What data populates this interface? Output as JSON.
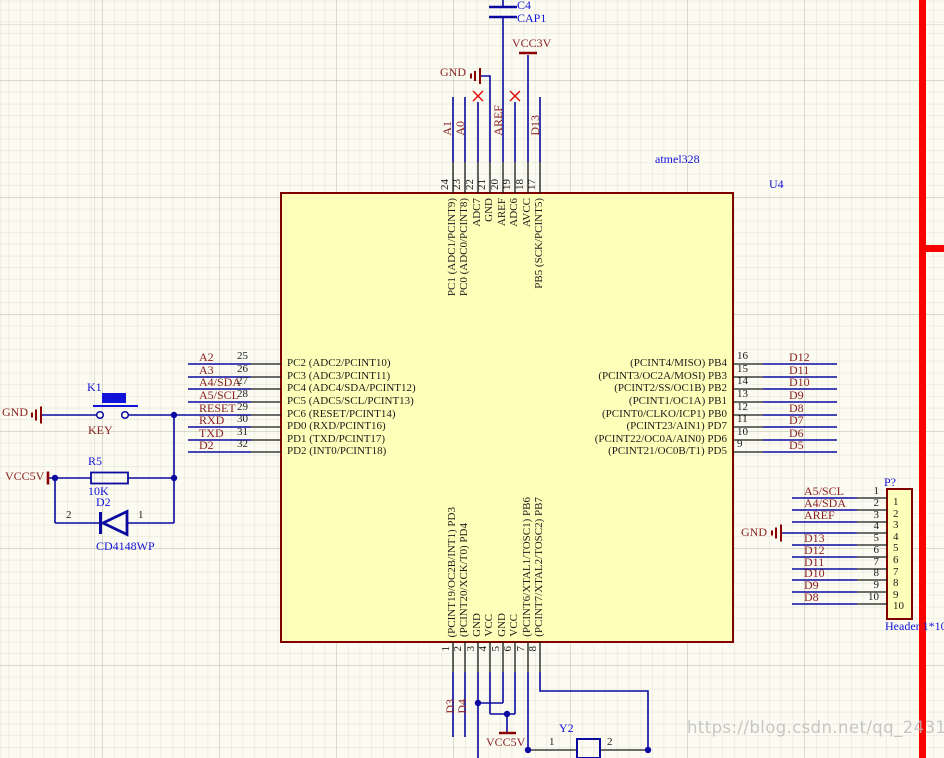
{
  "colors": {
    "wire": "#0A0AA0",
    "net_label": "#8B2222",
    "designator": "#1212D8",
    "ic_fill": "#FFFFB9",
    "ic_border": "#800000",
    "no_connect": "#E00000",
    "region_line": "#F80400"
  },
  "ic": {
    "designator": "U4",
    "comment": "atmel328",
    "top_pins": [
      {
        "num": "24",
        "net": "A1",
        "name": "PC1 (ADC1/PCINT9)"
      },
      {
        "num": "23",
        "net": "A0",
        "name": "PC0 (ADC0/PCINT8)"
      },
      {
        "num": "22",
        "net": "",
        "name": "ADC7"
      },
      {
        "num": "21",
        "net": "",
        "name": "GND"
      },
      {
        "num": "20",
        "net": "AREF",
        "name": "AREF"
      },
      {
        "num": "19",
        "net": "",
        "name": "ADC6"
      },
      {
        "num": "18",
        "net": "",
        "name": "AVCC"
      },
      {
        "num": "17",
        "net": "D13",
        "name": "PB5 (SCK/PCINT5)"
      }
    ],
    "left_pins": [
      {
        "num": "25",
        "net": "A2",
        "name": "PC2 (ADC2/PCINT10)"
      },
      {
        "num": "26",
        "net": "A3",
        "name": "PC3 (ADC3/PCINT11)"
      },
      {
        "num": "27",
        "net": "A4/SDA",
        "name": "PC4 (ADC4/SDA/PCINT12)"
      },
      {
        "num": "28",
        "net": "A5/SCL",
        "name": "PC5 (ADC5/SCL/PCINT13)"
      },
      {
        "num": "29",
        "net": "RESET",
        "name": "PC6 (RESET/PCINT14)"
      },
      {
        "num": "30",
        "net": "RXD",
        "name": "PD0 (RXD/PCINT16)"
      },
      {
        "num": "31",
        "net": "TXD",
        "name": "PD1 (TXD/PCINT17)"
      },
      {
        "num": "32",
        "net": "D2",
        "name": "PD2 (INT0/PCINT18)"
      }
    ],
    "right_pins": [
      {
        "num": "16",
        "net": "D12",
        "name": "(PCINT4/MISO) PB4"
      },
      {
        "num": "15",
        "net": "D11",
        "name": "(PCINT3/OC2A/MOSI) PB3"
      },
      {
        "num": "14",
        "net": "D10",
        "name": "(PCINT2/SS/OC1B) PB2"
      },
      {
        "num": "13",
        "net": "D9",
        "name": "(PCINT1/OC1A) PB1"
      },
      {
        "num": "12",
        "net": "D8",
        "name": "(PCINT0/CLKO/ICP1) PB0"
      },
      {
        "num": "11",
        "net": "D7",
        "name": "(PCINT23/AIN1) PD7"
      },
      {
        "num": "10",
        "net": "D6",
        "name": "(PCINT22/OC0A/AIN0) PD6"
      },
      {
        "num": "9",
        "net": "D5",
        "name": "(PCINT21/OC0B/T1) PD5"
      }
    ],
    "bottom_pins": [
      {
        "num": "1",
        "net": "D3",
        "name": "(PCINT19/OC2B/INT1) PD3"
      },
      {
        "num": "2",
        "net": "D4",
        "name": "(PCINT20/XCK/T0) PD4"
      },
      {
        "num": "3",
        "net": "",
        "name": "GND"
      },
      {
        "num": "4",
        "net": "",
        "name": "VCC"
      },
      {
        "num": "5",
        "net": "",
        "name": "GND"
      },
      {
        "num": "6",
        "net": "",
        "name": "VCC"
      },
      {
        "num": "7",
        "net": "",
        "name": "(PCINT6/XTAL1/TOSC1) PB6"
      },
      {
        "num": "8",
        "net": "",
        "name": "(PCINT7/XTAL2/TOSC2) PB7"
      }
    ]
  },
  "top": {
    "cap_designator": "C4",
    "cap_comment": "CAP1",
    "vcc": "VCC3V",
    "gnd": "GND"
  },
  "reset": {
    "gnd": "GND",
    "key_designator": "K1",
    "key_comment": "KEY",
    "vcc": "VCC5V",
    "res_designator": "R5",
    "res_value": "10K",
    "diode_designator": "D2",
    "diode_comment": "CD4148WP",
    "diode_pin1": "1",
    "diode_pin2": "2"
  },
  "bottom": {
    "vcc": "VCC5V",
    "crystal_designator": "Y2",
    "crystal_pin1": "1",
    "crystal_pin2": "2"
  },
  "conn": {
    "designator": "P?",
    "comment": "Header 1*10",
    "gnd": "GND",
    "pins": [
      {
        "num": "1",
        "inner": "1",
        "net": "A5/SCL"
      },
      {
        "num": "2",
        "inner": "2",
        "net": "A4/SDA"
      },
      {
        "num": "3",
        "inner": "3",
        "net": "AREF"
      },
      {
        "num": "4",
        "inner": "4",
        "net": ""
      },
      {
        "num": "5",
        "inner": "5",
        "net": "D13"
      },
      {
        "num": "6",
        "inner": "6",
        "net": "D12"
      },
      {
        "num": "7",
        "inner": "7",
        "net": "D11"
      },
      {
        "num": "8",
        "inner": "8",
        "net": "D10"
      },
      {
        "num": "9",
        "inner": "9",
        "net": "D9"
      },
      {
        "num": "10",
        "inner": "10",
        "net": "D8"
      }
    ]
  },
  "watermark": "https://blog.csdn.net/qq_24312945"
}
